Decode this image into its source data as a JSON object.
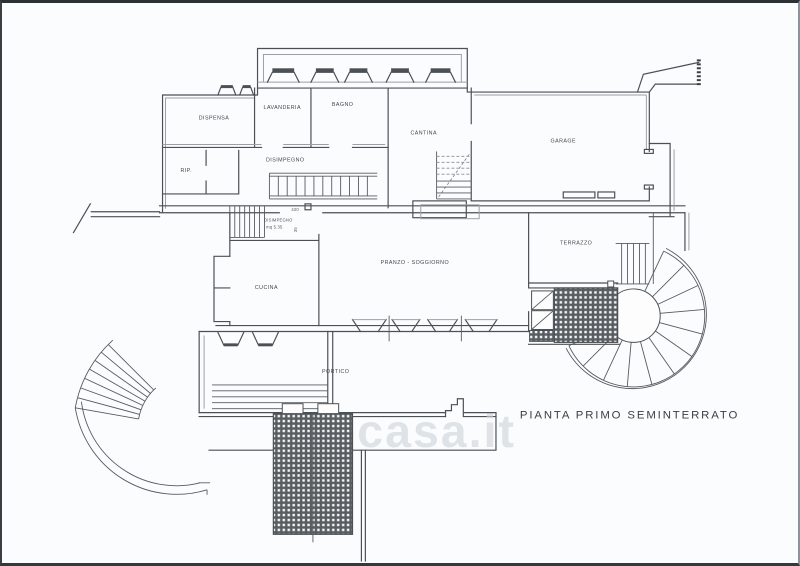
{
  "page": {
    "title": "PIANTA  PRIMO  SEMINTERRATO",
    "watermark": "casa.it",
    "background": "#fbfcfd",
    "line_color": "#4b5055"
  },
  "plan": {
    "rooms": [
      {
        "id": "dispensa",
        "label": "DISPENSA"
      },
      {
        "id": "lavanderia",
        "label": "LAVANDERIA"
      },
      {
        "id": "bagno",
        "label": "BAGNO"
      },
      {
        "id": "rip",
        "label": "RIP."
      },
      {
        "id": "disimpegno-nord",
        "label": "DISIMPEGNO"
      },
      {
        "id": "cantina",
        "label": "CANTINA"
      },
      {
        "id": "garage",
        "label": "GARAGE"
      },
      {
        "id": "disimpegno-sud",
        "label": "DISIMPEGNO",
        "area": "mq 5.35"
      },
      {
        "id": "cucina",
        "label": "CUCINA"
      },
      {
        "id": "pranzo-soggiorno",
        "label": "PRANZO - SOGGIORNO"
      },
      {
        "id": "terrazzo",
        "label": "TERRAZZO"
      },
      {
        "id": "portico",
        "label": "PORTICO"
      }
    ],
    "dimensions": [
      {
        "id": "door-width",
        "label": "420"
      },
      {
        "id": "door-height",
        "label": "35"
      }
    ]
  }
}
